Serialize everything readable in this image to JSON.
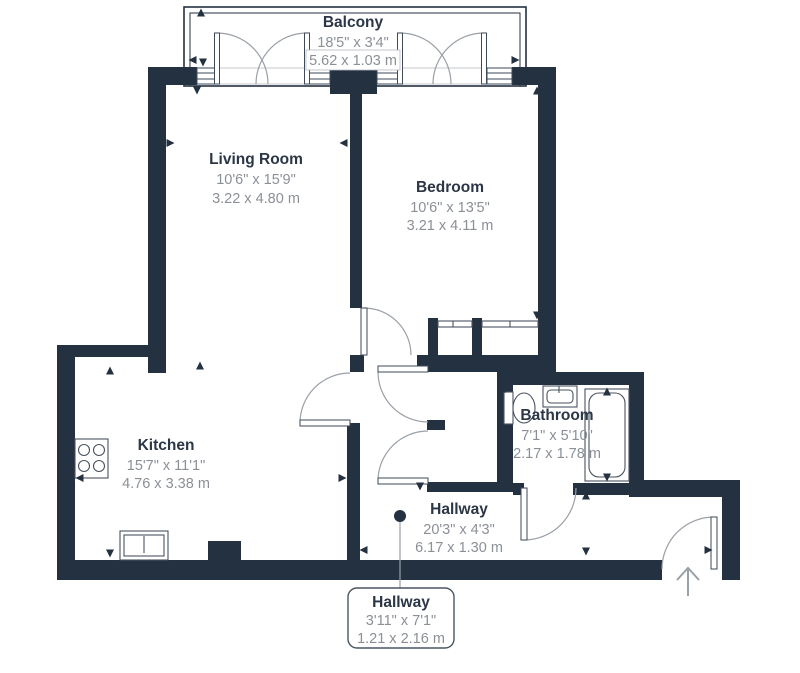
{
  "rooms": [
    {
      "id": "balcony",
      "name": "Balcony",
      "imperial": "18'5\" x 3'4\"",
      "metric": "5.62 x 1.03 m"
    },
    {
      "id": "living_room",
      "name": "Living Room",
      "imperial": "10'6\" x 15'9\"",
      "metric": "3.22 x 4.80 m"
    },
    {
      "id": "bedroom",
      "name": "Bedroom",
      "imperial": "10'6\" x 13'5\"",
      "metric": "3.21 x 4.11 m"
    },
    {
      "id": "kitchen",
      "name": "Kitchen",
      "imperial": "15'7\" x 11'1\"",
      "metric": "4.76 x 3.38 m"
    },
    {
      "id": "bathroom",
      "name": "Bathroom",
      "imperial": "7'1\" x 5'10\"",
      "metric": "2.17 x 1.78 m"
    },
    {
      "id": "hallway",
      "name": "Hallway",
      "imperial": "20'3\" x 4'3\"",
      "metric": "6.17 x 1.30 m"
    }
  ],
  "callout": {
    "name": "Hallway",
    "imperial": "3'11\" x 7'1\"",
    "metric": "1.21 x 2.16 m"
  },
  "colors": {
    "wall": "#233140",
    "room_name": "#2b3646",
    "dims": "#8b9097",
    "line": "#9aa0a8",
    "fixture": "#4a5360"
  }
}
